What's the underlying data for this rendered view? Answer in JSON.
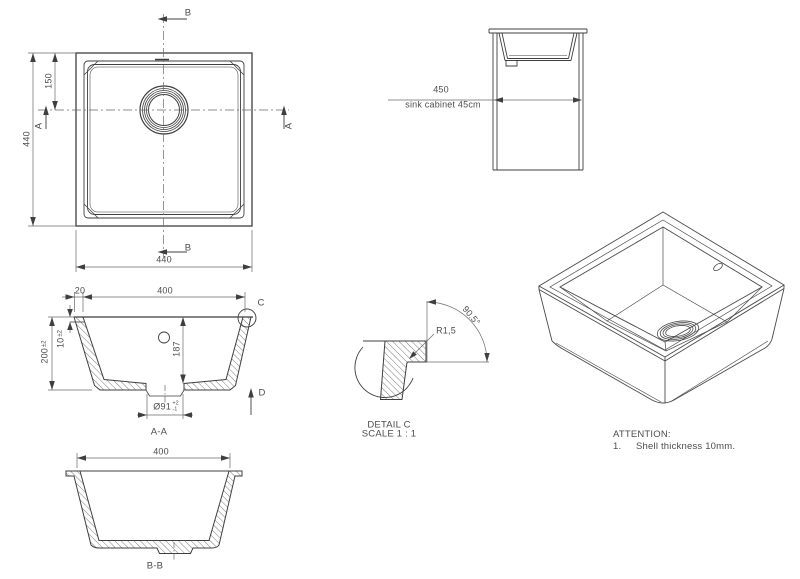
{
  "plan": {
    "marker_b": "B",
    "marker_a": "A",
    "dim_left": "440",
    "dim_offset": "150",
    "dim_bottom": "440"
  },
  "cabinet": {
    "dim": "450",
    "caption": "sink cabinet 45cm"
  },
  "section_aa": {
    "label": "A-A",
    "dim_wall": "20",
    "dim_width": "400",
    "dim_height": "200",
    "dim_height_tol": "±2",
    "dim_rim": "10",
    "dim_rim_tol": "±2",
    "dim_depth": "187",
    "dim_drain": "Ø91",
    "drain_tol_plus": "+2",
    "drain_tol_minus": "-1",
    "marker_c": "C",
    "marker_d": "D"
  },
  "detail_c": {
    "radius": "R1,5",
    "angle": "90.5°",
    "title": "DETAIL C",
    "scale": "SCALE 1 : 1"
  },
  "section_bb": {
    "label": "B-B",
    "dim_width": "400"
  },
  "notes": {
    "heading": "ATTENTION:",
    "item_number": "1.",
    "item_text": "Shell thickness 10mm."
  }
}
